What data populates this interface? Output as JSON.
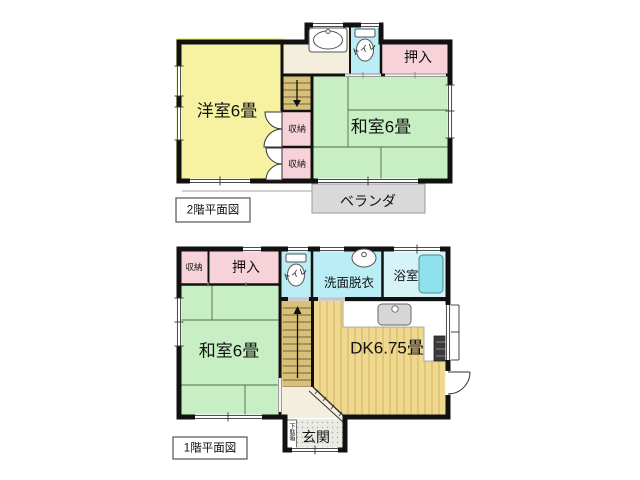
{
  "floor2": {
    "label": "2階平面図",
    "yoshitsu": "洋室6畳",
    "washitsu": "和室6畳",
    "oshiire": "押入",
    "toilet": "トイレ",
    "shuno1": "収納",
    "shuno2": "収納",
    "veranda": "ベランダ"
  },
  "floor1": {
    "label": "1階平面図",
    "shuno": "収納",
    "oshiire": "押入",
    "toilet": "トイレ",
    "senmen": "洗面脱衣",
    "yokushitsu": "浴室",
    "washitsu": "和室6畳",
    "dk": "DK6.75畳",
    "genkan": "玄関",
    "getabako": "下駄箱"
  },
  "colors": {
    "wall": "#111111",
    "western_room": "#f6f2a2",
    "tatami_room": "#c7efc3",
    "closet": "#f7d2d8",
    "toilet": "#baedf5",
    "bath": "#d6f3f7",
    "bathtub": "#8fe1eb",
    "hall": "#f4eedc",
    "stairs": "#d9c077",
    "wood_floor": "#eed98f",
    "veranda": "#d9d9d9",
    "entrance_tile": "#ebebe5"
  }
}
